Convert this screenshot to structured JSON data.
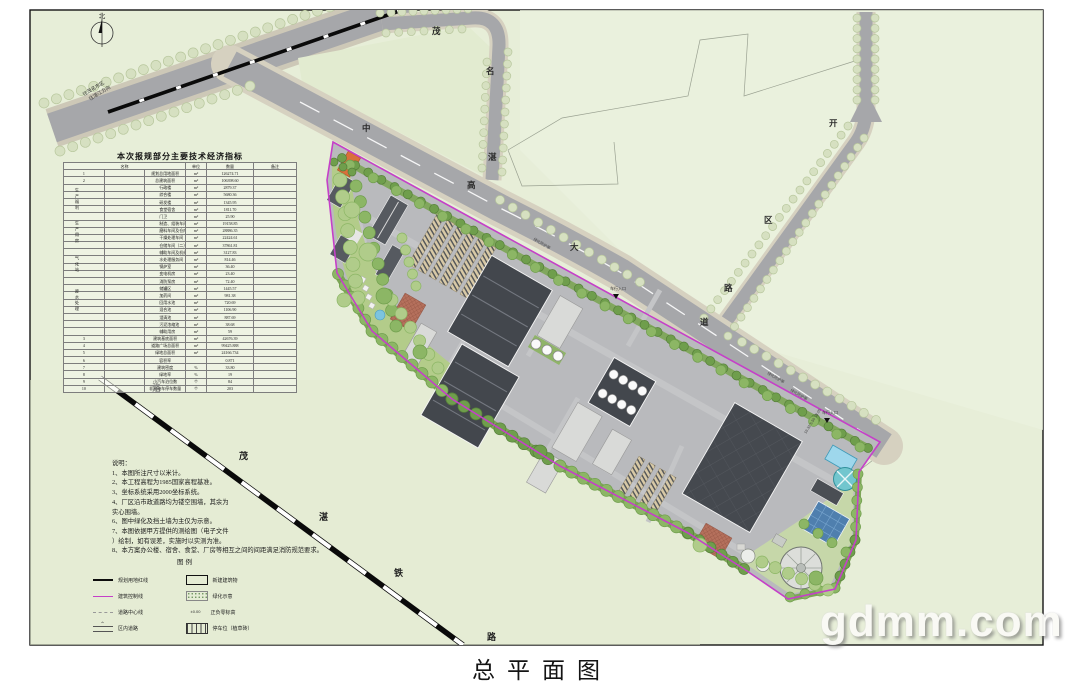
{
  "sheet": {
    "title": "总平面图",
    "watermark": "gdmm.com"
  },
  "map": {
    "north_label": "北",
    "road_main_chars": [
      "中",
      "高",
      "大",
      "道"
    ],
    "road_loop_chars": [
      "茂",
      "名",
      "湛"
    ],
    "road_east_chars": [
      "开",
      "区",
      "路"
    ],
    "railway_chars": [
      "洛",
      "茂",
      "湛",
      "铁",
      "路"
    ],
    "labels": {
      "to_maoming": "往茂名市区",
      "to_zhanjiang": "往湛江方向",
      "green_buffer": "绿化防护带",
      "vehicle_entrance": "车行入口",
      "entrance_dim": "19.32 5.50 18.00"
    }
  },
  "table": {
    "title": "本次报规部分主要技术经济指标",
    "headers": {
      "name": "名称",
      "unit": "单位",
      "qty": "数量",
      "remark": "备注"
    },
    "groups": [
      "生产福利",
      "生产用房",
      "气化站",
      "废水处理"
    ],
    "rows": [
      {
        "no": "1",
        "name": "规划总用地面积",
        "unit": "m²",
        "qty": "126274.71"
      },
      {
        "no": "2",
        "name": "总建筑面积",
        "unit": "m²",
        "qty": "106398.60"
      },
      {
        "name": "行政楼",
        "unit": "m²",
        "qty": "2879.37",
        "indent": true
      },
      {
        "name": "综合楼",
        "unit": "m²",
        "qty": "5680.36",
        "indent": true
      },
      {
        "name": "研发楼",
        "unit": "m²",
        "qty": "1345.95",
        "indent": true
      },
      {
        "name": "食堂宿舍",
        "unit": "m²",
        "qty": "1811.70",
        "indent": true
      },
      {
        "name": "门卫",
        "unit": "m²",
        "qty": "25.90",
        "indent": true
      },
      {
        "name": "制造、组装车间、机械储存总库房",
        "unit": "m²",
        "qty": "19158.85",
        "indent": true
      },
      {
        "name": "磨料车间及仓库B（一）",
        "unit": "m²",
        "qty": "28886.35",
        "indent": true
      },
      {
        "name": "干燥处理车间",
        "unit": "m²",
        "qty": "22424.61",
        "indent": true
      },
      {
        "name": "仓储车间（二）",
        "unit": "m²",
        "qty": "37861.81",
        "indent": true
      },
      {
        "name": "辅助车间及机修用房",
        "unit": "m²",
        "qty": "3127.83",
        "indent": true
      },
      {
        "name": "水处理服务间",
        "unit": "m²",
        "qty": "814.46",
        "indent": true
      },
      {
        "name": "锅炉室",
        "unit": "m²",
        "qty": "36.40",
        "indent": true
      },
      {
        "name": "变电机房",
        "unit": "m²",
        "qty": "23.40",
        "indent": true
      },
      {
        "name": "消防泵房",
        "unit": "m²",
        "qty": "72.40",
        "indent": true
      },
      {
        "name": "储罐区",
        "unit": "m²",
        "qty": "1445.57",
        "indent": true
      },
      {
        "name": "加药间",
        "unit": "m²",
        "qty": "981.38",
        "indent": true
      },
      {
        "name": "回用水池",
        "unit": "m²",
        "qty": "720.69",
        "indent": true
      },
      {
        "name": "混合池",
        "unit": "m²",
        "qty": "1106.90",
        "indent": true
      },
      {
        "name": "澄清池",
        "unit": "m²",
        "qty": "887.69",
        "indent": true
      },
      {
        "name": "污泥浓缩池",
        "unit": "m²",
        "qty": "38.68",
        "indent": true
      },
      {
        "name": "辅助用房",
        "unit": "m²",
        "qty": "59",
        "indent": true
      },
      {
        "no": "3",
        "name": "建筑基底面积",
        "unit": "m²",
        "qty": "42676.39"
      },
      {
        "no": "4",
        "name": "道路广场总面积",
        "unit": "m²",
        "qty": "99425.888"
      },
      {
        "no": "5",
        "name": "绿地总面积",
        "unit": "m²",
        "qty": "24166.734"
      },
      {
        "no": "6",
        "name": "容积率",
        "unit": "",
        "qty": "0.871"
      },
      {
        "no": "7",
        "name": "建筑密度",
        "unit": "%",
        "qty": "33.80"
      },
      {
        "no": "8",
        "name": "绿地率",
        "unit": "%",
        "qty": "19"
      },
      {
        "no": "9",
        "name": "小汽车泊位数",
        "unit": "个",
        "qty": "84"
      },
      {
        "no": "10",
        "name": "非机动车停车数量",
        "unit": "个",
        "qty": "203"
      }
    ]
  },
  "notes": {
    "lines": [
      "说明：",
      "1、本图所注尺寸以米计。",
      "2、本工程高程为1985国家高程基准。",
      "3、坐标系统采用2000坐标系统。",
      "4、厂区沿市政道路均为镂空围墙，其余为",
      "实心围墙。",
      "6、图中绿化及挡土墙为主仅为示意。",
      "7、本图依据甲方提供的测绘图（电子文件",
      "）绘制，如有误差，实施时以实测为准。",
      "8、本方案办公楼、宿舍、食堂、厂房等相互之间的间距满足消防规范要求。"
    ]
  },
  "legend": {
    "title": "图例",
    "left": [
      {
        "label": "规划用地红线",
        "icon": "redline"
      },
      {
        "label": "建筑控制线",
        "icon": "magenta-line"
      },
      {
        "label": "道路中心线",
        "icon": "centerline"
      },
      {
        "label": "区内道路",
        "icon": "inner-road"
      }
    ],
    "right": [
      {
        "label": "新建建筑物",
        "icon": "new-building"
      },
      {
        "label": "绿化示意",
        "icon": "greening"
      },
      {
        "label": "正负零标高",
        "icon": "level-mark",
        "symbol": "±0.00"
      },
      {
        "label": "停车位（植草砖）",
        "icon": "parking"
      }
    ]
  }
}
